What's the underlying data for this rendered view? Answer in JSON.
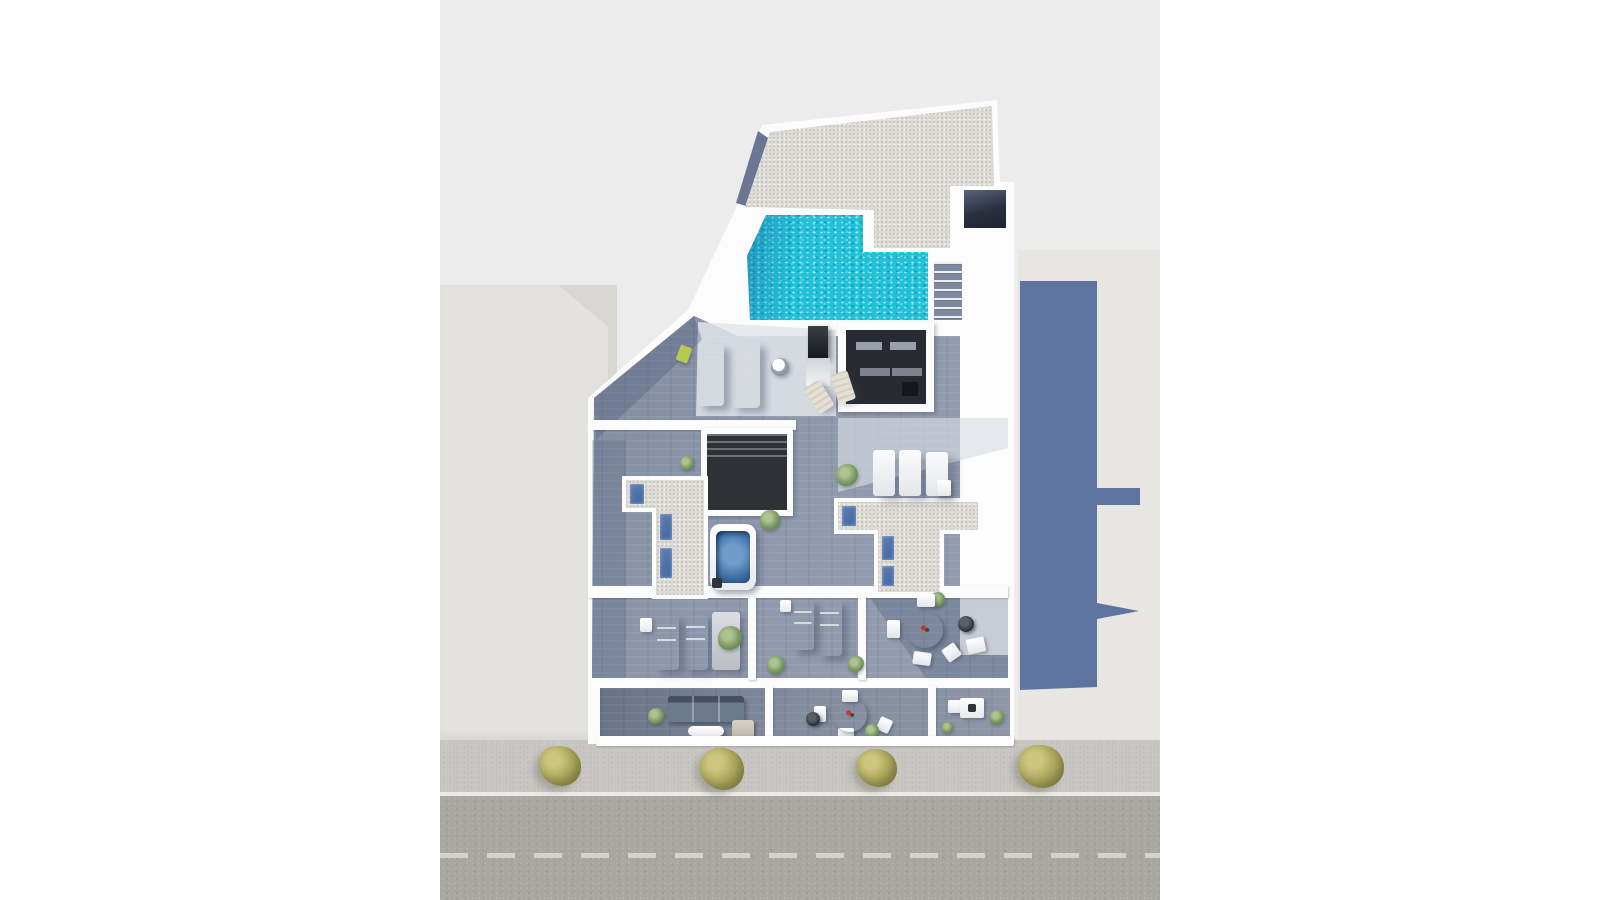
{
  "scene": {
    "title": "Top-down 3D architectural render of a penthouse roof level with pool terrace, neighbouring buildings and street",
    "view": "aerial top-down",
    "palette": {
      "page_bg": "#ffffff",
      "canvas_bg": "#ececec",
      "neighbor_left": "#e3e2df",
      "neighbor_left_edge": "#d8d7d3",
      "neighbor_right": "#e7e6e3",
      "cast_shadow": "#5d74a0",
      "wall_white": "#fcfcfc",
      "gravel": "#dcdad4",
      "gravel_dot": "#c7c4bc",
      "deck_base": "#8d97ab",
      "deck_dark": "#707c93",
      "deck_light": "#ccd1da",
      "walkway_dark": "#6b7690",
      "pool_water": "#21c2d8",
      "pool_deep": "#1c6da7",
      "hot_tub": "#4273a8",
      "skylight": "#2e3237",
      "glass_strip": "#4a6da6",
      "sofa_blue": "#6b7a8d",
      "street": "#a8a7a2",
      "sidewalk": "#c8c7c3",
      "curb": "#ebeae6",
      "lane_dash": "#d8d7d2",
      "tree": "#b2ac62",
      "plant": "#7c9a64",
      "furniture_white": "#f5f6f7",
      "furniture_beige": "#e5ded2",
      "dark_item": "#2f3338"
    },
    "features": {
      "rooftop": [
        "gravel flat roof",
        "swimming pool with shaded deep end",
        "white pool parapet",
        "staircase with railing",
        "wood-deck walkway",
        "open atrium void",
        "large dark skylight",
        "glass skylight strips in pebble paths",
        "hot tub",
        "sun terraces with wood decking"
      ],
      "furniture_counts": {
        "pool_terrace_loungers": 2,
        "folding_deck_chairs": 2,
        "towel_cabinet": 1,
        "sunbeds": 3,
        "lower_terrace_loungers": 4,
        "rooftop_dining_chairs": 4,
        "balcony_sofa": 1,
        "balcony_dining_chairs": 4,
        "balcony_desk": 1,
        "potted_plants": 10
      },
      "street": {
        "lane_marking": "dashed white center line",
        "sidewalk_trees": 4
      },
      "neighbours": [
        "flat light-grey building on the left",
        "light-grey building on the right with long blue cast shadow"
      ]
    }
  }
}
